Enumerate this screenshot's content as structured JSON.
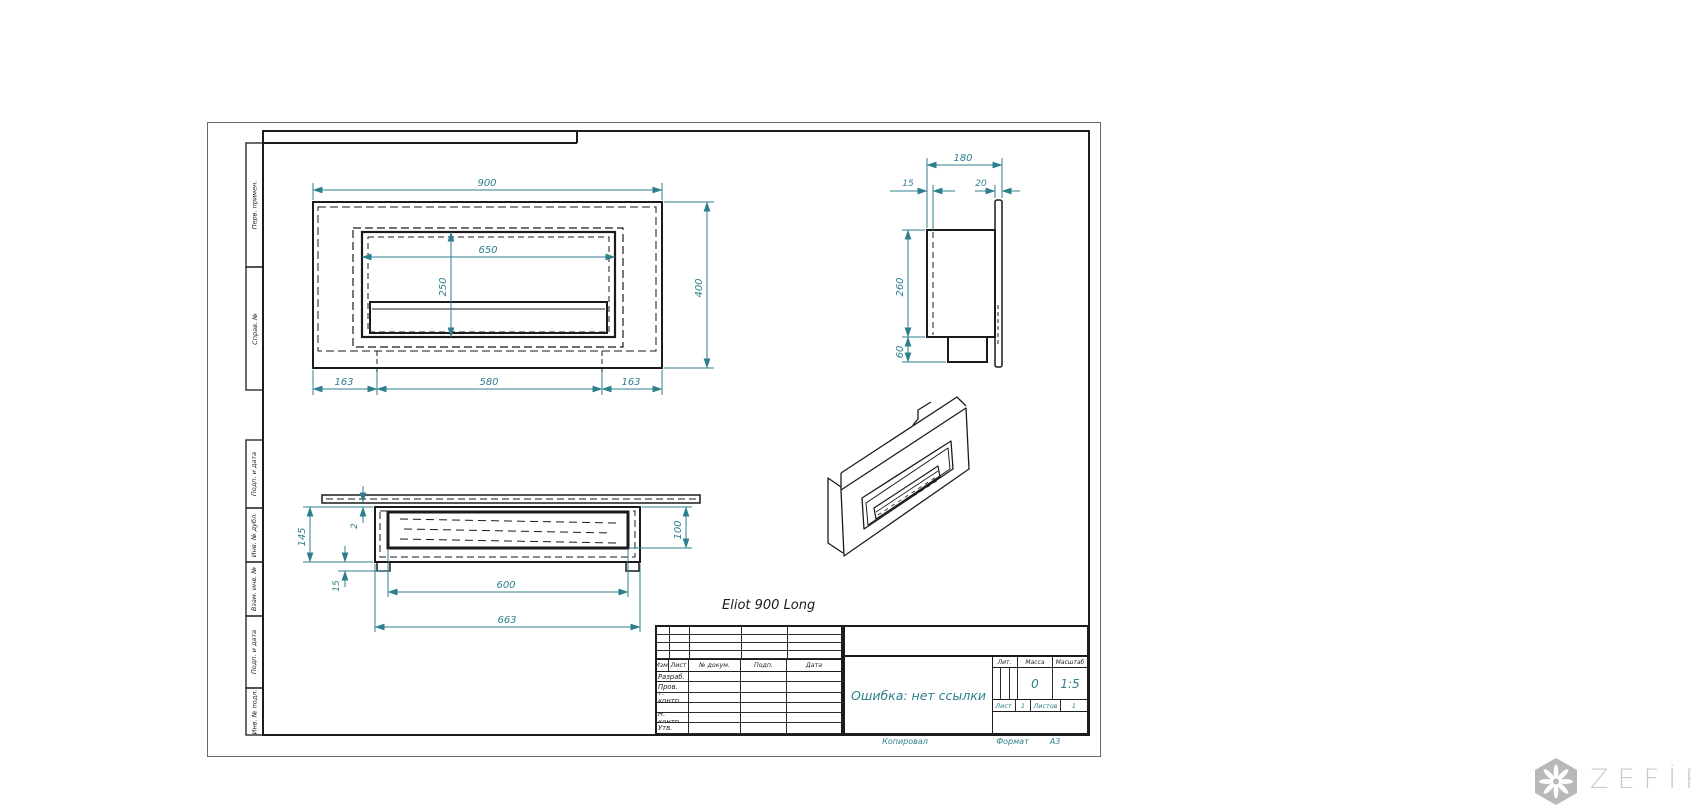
{
  "colors": {
    "line": "#1b1b1b",
    "dimension": "#2e7f8c",
    "watermark": "#c9c9c9"
  },
  "drawing_title": "Eliot 900 Long",
  "frame_columns": {
    "top": [
      "Перв. примен.",
      "Справ. №"
    ],
    "bottom": [
      "Подп. и дата",
      "Инв. № дубл.",
      "Взам. инв. №",
      "Подп. и дата",
      "Инв. № подл."
    ]
  },
  "views": {
    "front": {
      "dim_width": "900",
      "dim_opening_width": "650",
      "dim_opening_height": "250",
      "dim_height": "400",
      "dim_left": "163",
      "dim_center": "580",
      "dim_right": "163"
    },
    "side": {
      "dim_depth": "180",
      "dim_inset": "15",
      "dim_flange": "20",
      "dim_height": "260",
      "dim_bottom": "60"
    },
    "section": {
      "dim_height": "145",
      "dim_gap": "2",
      "dim_foot": "15",
      "dim_slot": "600",
      "dim_length": "663",
      "dim_depth": "100"
    }
  },
  "title_block": {
    "header_cols": [
      "Изм.",
      "Лист",
      "№ докум.",
      "Подп.",
      "Дата"
    ],
    "row_labels": [
      "Разраб.",
      "Пров.",
      "Т. контр.",
      "",
      "Н. контр.",
      "Утв."
    ],
    "name_value": "Ошибка: нет ссылки",
    "lit_label": "Лит.",
    "mass_label": "Масса",
    "scale_label": "Масштаб",
    "mass_value": "0",
    "scale_value": "1:5",
    "sheet_label": "Лист",
    "sheet_value": "1",
    "sheets_label": "Листов",
    "sheets_value": "1",
    "copied_label": "Копировал",
    "format_label": "Формат",
    "format_value": "А3"
  },
  "watermark": {
    "brand": "ZEFİRE"
  }
}
